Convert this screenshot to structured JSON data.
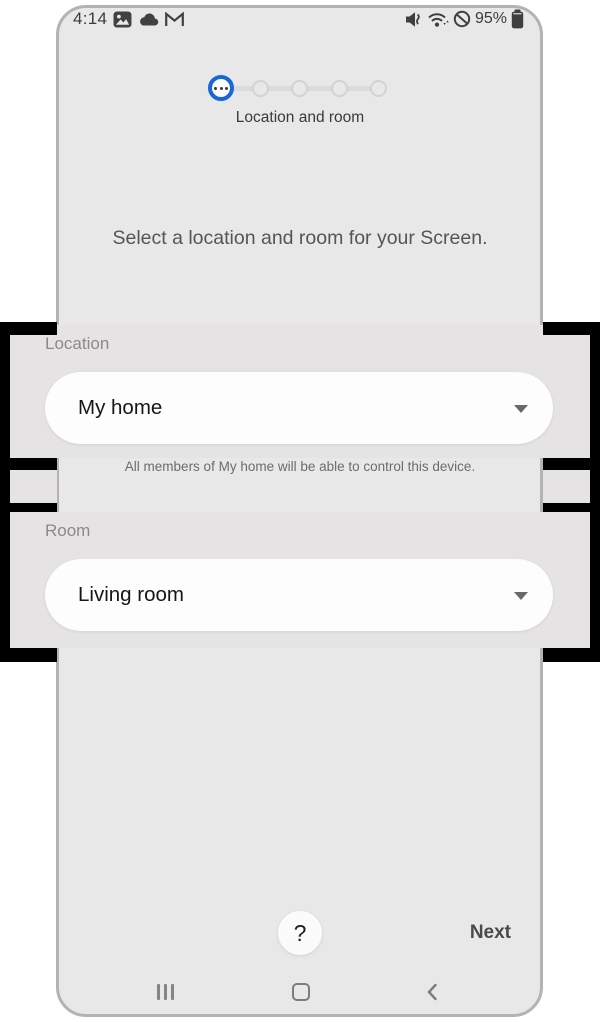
{
  "status_bar": {
    "time": "4:14",
    "battery_percent": "95%",
    "left_icons": [
      "photo-icon",
      "cloud-icon",
      "gmail-icon"
    ],
    "right_icons": [
      "mute-icon",
      "wifi-icon",
      "blocked-icon",
      "battery-icon"
    ]
  },
  "wizard": {
    "step_label": "Location and room",
    "total_steps": 5,
    "current_step": 1
  },
  "instruction": "Select a location and room for your Screen.",
  "form": {
    "location": {
      "label": "Location",
      "value": "My home",
      "helper": "All members of My home will be able to control this device."
    },
    "room": {
      "label": "Room",
      "value": "Living room"
    }
  },
  "footer": {
    "help_label": "?",
    "next_label": "Next"
  },
  "nav_bar": {
    "icons": [
      "recents-icon",
      "home-icon",
      "back-icon"
    ]
  },
  "colors": {
    "accent_blue": "#1467e2",
    "highlight_border": "#000000",
    "screen_bg": "#e9e8e8",
    "callout_bg": "#e5e3e3",
    "pill_bg": "#fdfdfd"
  }
}
